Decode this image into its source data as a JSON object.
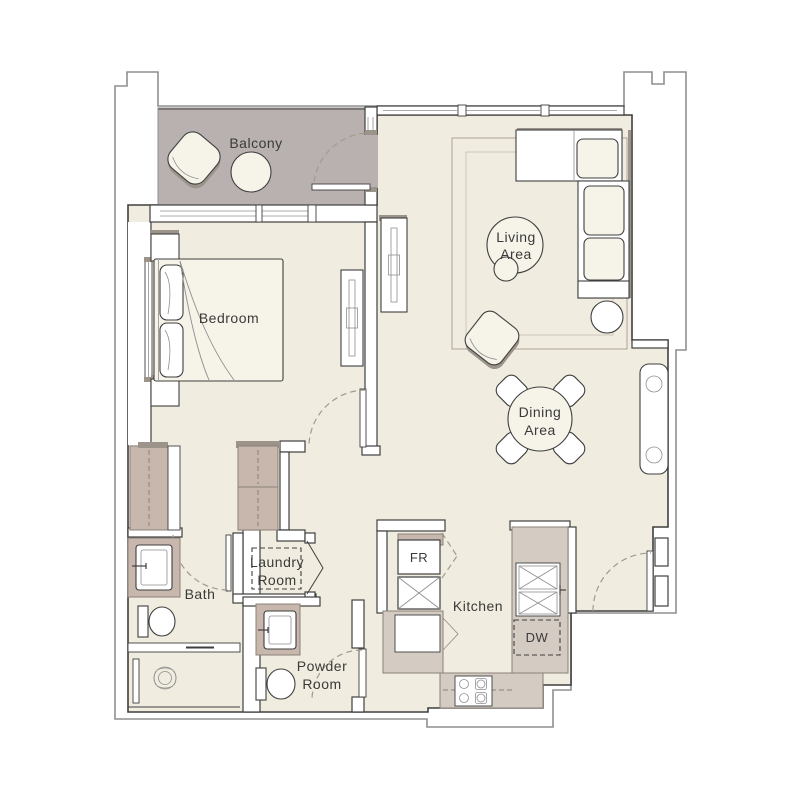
{
  "plan": {
    "type": "apartment-floor-plan",
    "rooms": {
      "balcony": {
        "label": "Balcony"
      },
      "bedroom": {
        "label": "Bedroom"
      },
      "living": {
        "line1": "Living",
        "line2": "Area"
      },
      "dining": {
        "line1": "Dining",
        "line2": "Area"
      },
      "bath": {
        "label": "Bath"
      },
      "laundry": {
        "line1": "Laundry",
        "line2": "Room"
      },
      "powder": {
        "line1": "Powder",
        "line2": "Room"
      },
      "kitchen": {
        "label": "Kitchen"
      }
    },
    "appliances": {
      "fridge": "FR",
      "dishwasher": "DW"
    }
  },
  "colors": {
    "floor": "#f0ecdf",
    "balcony": "#b8b1b0",
    "closet": "#c8b7ac",
    "closetstroke": "#8a8178",
    "counter": "#d4cbc3",
    "stroke": "#3f3f3f",
    "outline": "#8f8f8f",
    "dash": "#a39a8e",
    "text": "#3a3a3a",
    "furn": "#f6f3e9",
    "shadow": "#9c948b"
  }
}
